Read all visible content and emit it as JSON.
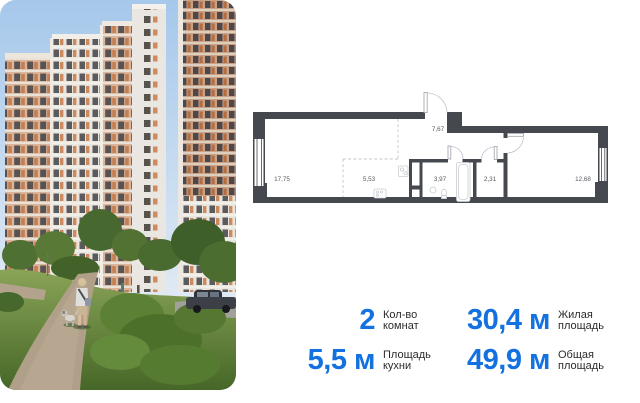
{
  "card": {
    "background": "#ffffff"
  },
  "photo": {
    "scene": "Residential towers with white and terracotta grid facades above a green courtyard; a person walks a small dog along a gravel path; a dark car is parked at the right",
    "sky_color": "#aecbea",
    "accent_facade_color": "#c98a5e"
  },
  "floor_plan": {
    "wall_color": "#45494f",
    "rooms": [
      {
        "name": "living-room",
        "area": "17,75"
      },
      {
        "name": "kitchen",
        "area": "5,53"
      },
      {
        "name": "hallway",
        "area": "7,67"
      },
      {
        "name": "bathroom",
        "area": "3,97"
      },
      {
        "name": "wardrobe",
        "area": "2,31"
      },
      {
        "name": "bedroom",
        "area": "12,68"
      }
    ]
  },
  "stats": {
    "accent_color": "#1372e0",
    "items": [
      {
        "value": "2",
        "label_line1": "Кол-во",
        "label_line2": "комнат"
      },
      {
        "value": "30,4 м",
        "label_line1": "Жилая",
        "label_line2": "площадь"
      },
      {
        "value": "5,5 м",
        "label_line1": "Площадь",
        "label_line2": "кухни"
      },
      {
        "value": "49,9 м",
        "label_line1": "Общая",
        "label_line2": "площадь"
      }
    ]
  }
}
